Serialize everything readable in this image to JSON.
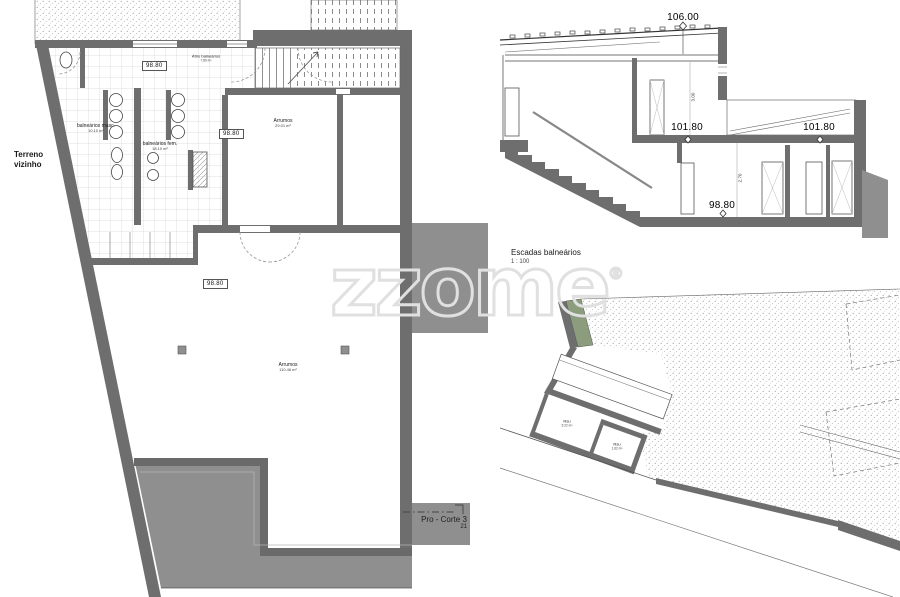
{
  "watermark": {
    "text": "zzome",
    "registered": "®"
  },
  "floor_plan": {
    "neighbor": {
      "line1": "Terreno",
      "line2": "vizinho"
    },
    "levels": {
      "hall": "98.80",
      "storage_upper": "98.80",
      "storage_lower": "98.80"
    },
    "rooms": {
      "atrio": {
        "name": "Átrio balneários",
        "area": "7.80 m²"
      },
      "masc": {
        "name": "balneários masc.",
        "area": "10.10 m²"
      },
      "fem": {
        "name": "balneários fem.",
        "area": "18.10 m²"
      },
      "storage_upper": {
        "name": "Arrumos",
        "area": "29.01 m²"
      },
      "storage_lower": {
        "name": "Arrumos",
        "area": "110.46 m²"
      }
    },
    "section_marker": {
      "label": "Pro - Corte 3",
      "sheet": "21"
    }
  },
  "section": {
    "title": "Escadas balneários",
    "scale": "1 : 100",
    "levels": {
      "roof": "106.00",
      "upper_left": "101.80",
      "upper_right": "101.80",
      "floor": "98.80"
    },
    "dimensions": {
      "upper": "3.00",
      "lower": "2.70"
    }
  },
  "site_plan": {
    "rooms": {
      "rsu_large": {
        "name": "Rsu",
        "area": "5.22 m²"
      },
      "rsu_small": {
        "name": "Rsu",
        "area": "1.62 m²"
      }
    }
  },
  "colors": {
    "wall": "#6e6e6e",
    "earth": "#8f8f8f",
    "green": "#8c9d7e",
    "tile_line": "#d5d5d5",
    "watermark": "#e0e0e0"
  }
}
